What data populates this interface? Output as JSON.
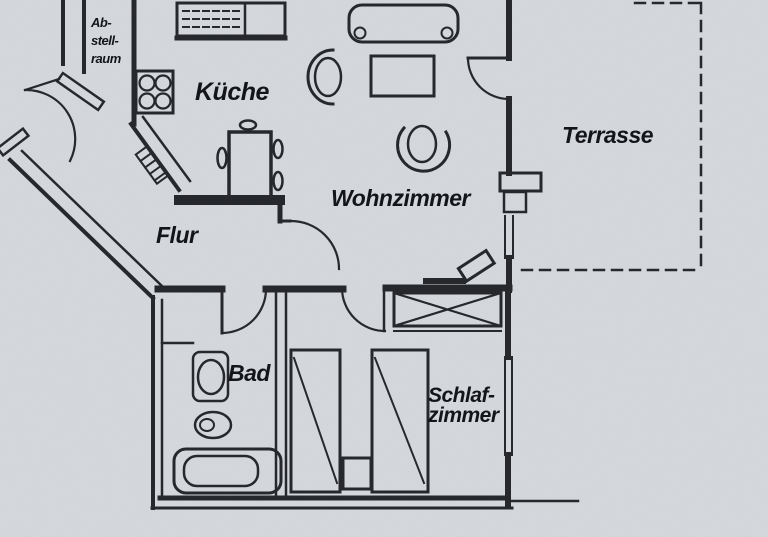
{
  "title": "Apartment floor plan (German)",
  "colors": {
    "background": "#d6d9dd",
    "ink": "#26282c",
    "label": "#141518"
  },
  "rooms": {
    "abstellraum": {
      "label_lines": [
        "Ab-",
        "stell-",
        "raum"
      ]
    },
    "kueche": {
      "label": "Küche"
    },
    "wohnzimmer": {
      "label": "Wohnzimmer"
    },
    "terrasse": {
      "label": "Terrasse"
    },
    "flur": {
      "label": "Flur"
    },
    "bad": {
      "label": "Bad"
    },
    "schlafzimmer": {
      "label_lines": [
        "Schlaf-",
        "zimmer"
      ]
    }
  }
}
